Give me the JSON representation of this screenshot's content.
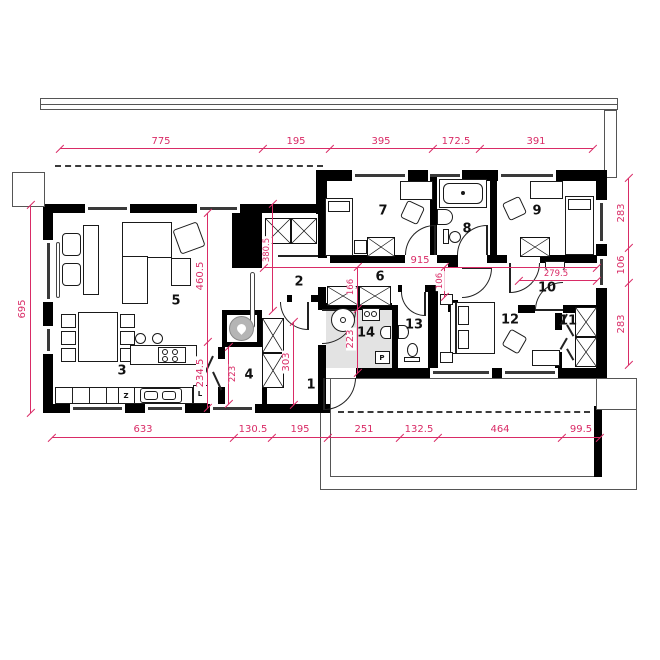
{
  "plan_title": "floor-plan",
  "rooms": [
    "1",
    "2",
    "3",
    "4",
    "5",
    "6",
    "7",
    "8",
    "9",
    "10",
    "11",
    "12",
    "13",
    "14"
  ],
  "dims": {
    "top": [
      "775",
      "195",
      "395",
      "172.5",
      "391"
    ],
    "bottom": [
      "633",
      "130.5",
      "195",
      "251",
      "132.5",
      "464",
      "99.5"
    ],
    "left": "695",
    "right": [
      "283",
      "106",
      "283"
    ],
    "interior": {
      "overall_width": "915",
      "hall_depth": "380.5",
      "living_width": "460.5",
      "kitchen_width": "234.5",
      "corridor_a": "166",
      "corridor_b": "106",
      "room10_width": "279.5",
      "bath_depth": "223",
      "boiler_depth": "223",
      "vestibule_depth": "303"
    }
  },
  "appliances": {
    "dishwasher": "Z",
    "fridge": "L",
    "washer": "P"
  },
  "colors": {
    "dimension": "#d92b66",
    "walls": "#000000",
    "bath_floor": "#e3e3e3"
  }
}
